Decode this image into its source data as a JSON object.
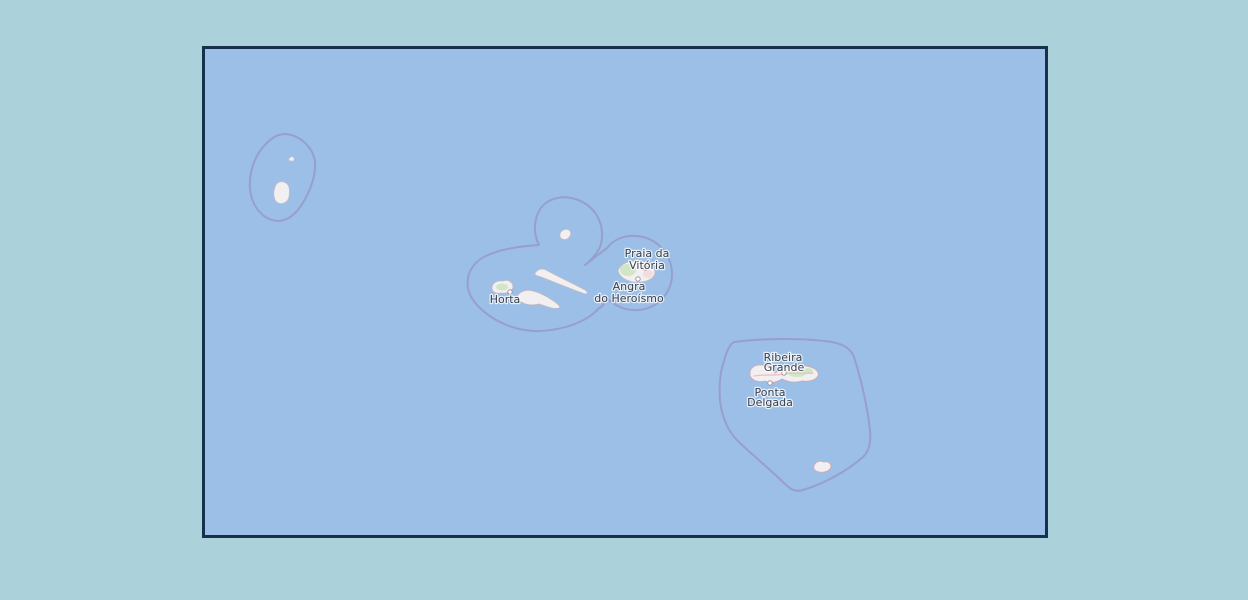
{
  "map": {
    "description": "Slippy-map view of the Azores archipelago with administrative boundaries",
    "colors": {
      "page_background": "#abd2db",
      "ocean": "#9bbfe7",
      "frame_border": "#17314d",
      "admin_boundary": "#9899c6",
      "island_fill": "#f2eff1",
      "green_area": "#cde5c4",
      "road_pink": "#f0bcc1",
      "label_text": "#39414d"
    },
    "places": [
      {
        "id": "praia-da-vitoria",
        "name": "Praia da Vitória",
        "name_lines": [
          "Praia da",
          "Vitória"
        ]
      },
      {
        "id": "angra-do-heroismo",
        "name": "Angra do Heroísmo",
        "name_lines": [
          "Angra",
          "do Heroísmo"
        ]
      },
      {
        "id": "horta",
        "name": "Horta",
        "name_lines": [
          "Horta"
        ]
      },
      {
        "id": "ribeira-grande",
        "name": "Ribeira Grande",
        "name_lines": [
          "Ribeira",
          "Grande"
        ]
      },
      {
        "id": "ponta-delgada",
        "name": "Ponta Delgada",
        "name_lines": [
          "Ponta",
          "Delgada"
        ]
      }
    ]
  }
}
